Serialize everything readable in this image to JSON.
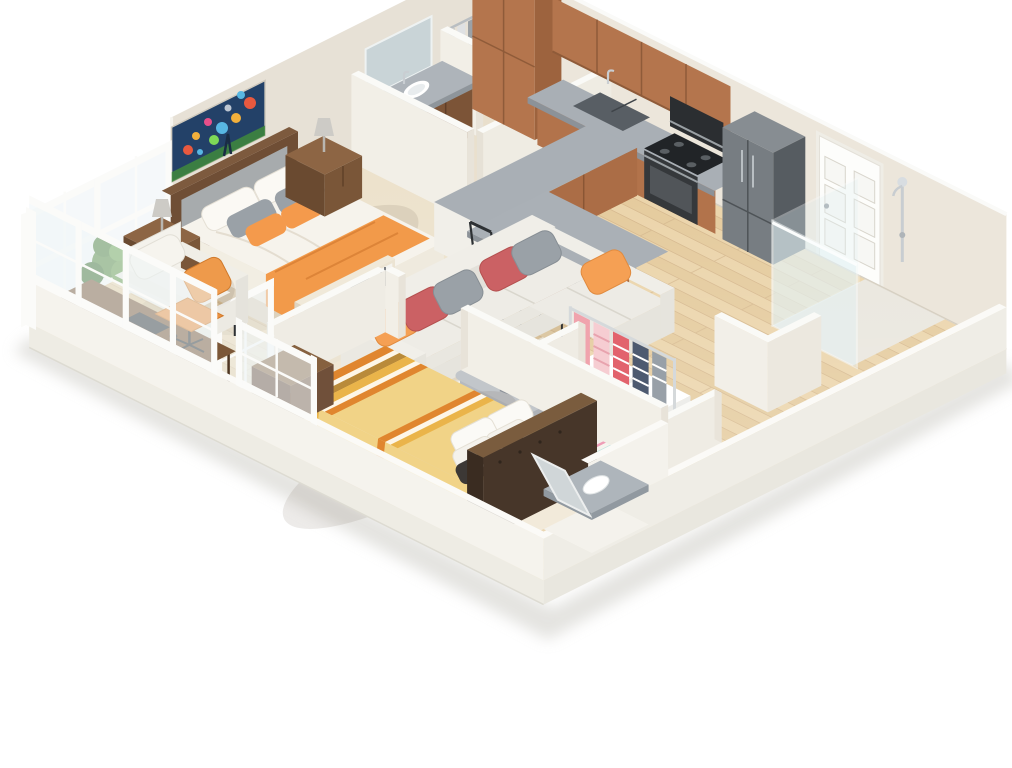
{
  "scene": {
    "kind": "isometric-3d-floor-plan-render",
    "aria_label": "3D rendered isometric floor plan of an apartment with master bedroom, bathroom, kitchen, living room, walk-in closet, second bedroom, shower bathroom and a window-enclosed sunroom office",
    "background": "#ffffff"
  },
  "palette": {
    "wall_left": "#e7e1d6",
    "wall_right": "#ece6db",
    "partition": "#f2efe7",
    "partition_shadow": "#ddd6c9",
    "wall_top": "#fafaf7",
    "plinth": "#f2f0ea",
    "hardwood": "#e7cfa4",
    "carpet": "#ece1ca",
    "tile": "#e9dfcc",
    "granite": "#a9afb5",
    "granite_edge": "#8c9298",
    "cabinet_wood": "#b2734b",
    "dark_wood": "#7a5638",
    "stainless": "#777d82",
    "appliance_black": "#2c2f32",
    "sofa_fabric": "#eceae4",
    "accent_orange": "#f5a054",
    "accent_rose": "#cb6164",
    "accent_gray": "#9aa1a7",
    "bedding_yellow": "#f1d387",
    "stripe_orange": "#e0862f",
    "clothes_pink": "#f0a3ad",
    "plant_green": "#55883f",
    "glass": "#eef4f6",
    "door_white": "#fdfdfb"
  },
  "rooms": [
    {
      "name": "master-bedroom",
      "floor": "carpet",
      "furniture": [
        "double-bed-white-duvet",
        "gray-upholstered-headboard",
        "orange-throw-blanket",
        "nightstand-with-lamp-left",
        "nightstand-with-lamp-right",
        "abstract-wall-painting",
        "tall-left-wall-windows"
      ]
    },
    {
      "name": "bathroom-1",
      "floor": "tile",
      "furniture": [
        "dark-wood-vanity-granite-top",
        "white-sink",
        "wall-mirror",
        "toilet",
        "corner-closet-hanging-clothes"
      ]
    },
    {
      "name": "kitchen",
      "floor": "hardwood",
      "furniture": [
        "tall-pantry-cabinet",
        "upper-cabinets",
        "base-cabinets-granite-counter",
        "double-sink",
        "gas-range",
        "built-in-wall-oven",
        "stainless-refrigerator",
        "curved-granite-breakfast-bar",
        "bar-stool-1",
        "bar-stool-2",
        "bar-stool-3"
      ],
      "entry_door": "white-six-panel-door"
    },
    {
      "name": "living-room",
      "floor": "hardwood",
      "furniture": [
        "l-shaped-sectional-sofa",
        "throw-pillows-orange-rose-gray",
        "striped-multicolor-area-rug",
        "gray-curved-coffee-table",
        "flower-vase",
        "cube-shelf-with-colored-bins"
      ]
    },
    {
      "name": "sunroom-office",
      "floor": "hardwood",
      "furniture": [
        "white-armchair",
        "potted-plant",
        "dark-wood-desk",
        "keyboard",
        "orange-office-chair",
        "white-framed-window-walls"
      ]
    },
    {
      "name": "walk-in-closet",
      "floor": "hardwood",
      "furniture": [
        "metal-clothes-rack",
        "pink-and-striped-clothes",
        "white-storage-boxes"
      ]
    },
    {
      "name": "bedroom-2",
      "floor": "carpet",
      "furniture": [
        "bed-yellow-orange-striped-bedding",
        "dark-upholstered-headboard",
        "wood-nightstand",
        "front-wall-window",
        "red-slippers"
      ]
    },
    {
      "name": "bathroom-2",
      "floor": "hardwood",
      "furniture": [
        "glass-walk-in-shower",
        "chrome-shower-fixture",
        "low-wall-enclosure",
        "granite-vanity-white-sink",
        "leaning-mirror"
      ]
    }
  ]
}
